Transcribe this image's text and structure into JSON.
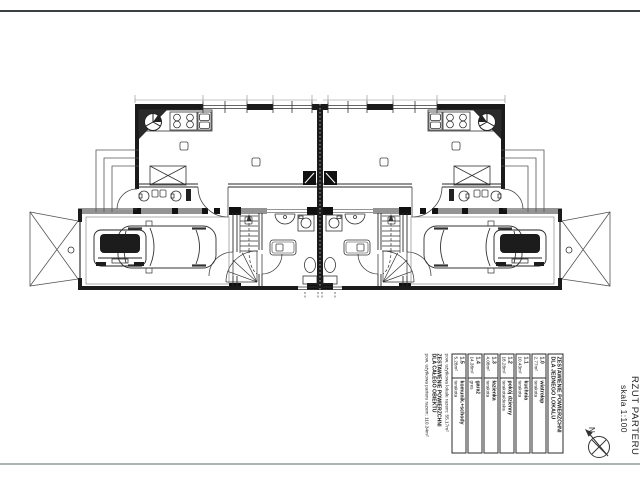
{
  "title_block": {
    "title": "RZUT PARTERU",
    "scale": "skala 1:100",
    "north_label": "N"
  },
  "area_table": {
    "unit_header": [
      "ZESTAWIENIE POWIERZCHNI",
      "DLA JEDNEGO LOKALU"
    ],
    "rows": [
      {
        "no": "1.0",
        "name": "wiatrołap",
        "area": "2.77m²",
        "finish": "terakota"
      },
      {
        "no": "1.1",
        "name": "kuchnia",
        "area": "10.43m²",
        "finish": "terakota"
      },
      {
        "no": "1.2",
        "name": "pokój dzienny",
        "area": "18.28m²",
        "finish": "terakota/deska"
      },
      {
        "no": "1.3",
        "name": "łazienka",
        "area": "4.08m²",
        "finish": "terakota"
      },
      {
        "no": "1.4",
        "name": "garaż",
        "area": "14.38m²",
        "finish": "gres"
      },
      {
        "no": "1.5",
        "name": "komunik.+schody",
        "area": "5.28m²",
        "finish": "terakota"
      }
    ],
    "unit_total": "pow. użytkowa lokalu razem: 55.17m²",
    "building_header": [
      "ZESTAWIENIE POWIERZCHNI",
      "DLA CAŁEGO OBIEKTU"
    ],
    "building_total": "pow. użytkowa parteru razem: 110.34m²"
  }
}
